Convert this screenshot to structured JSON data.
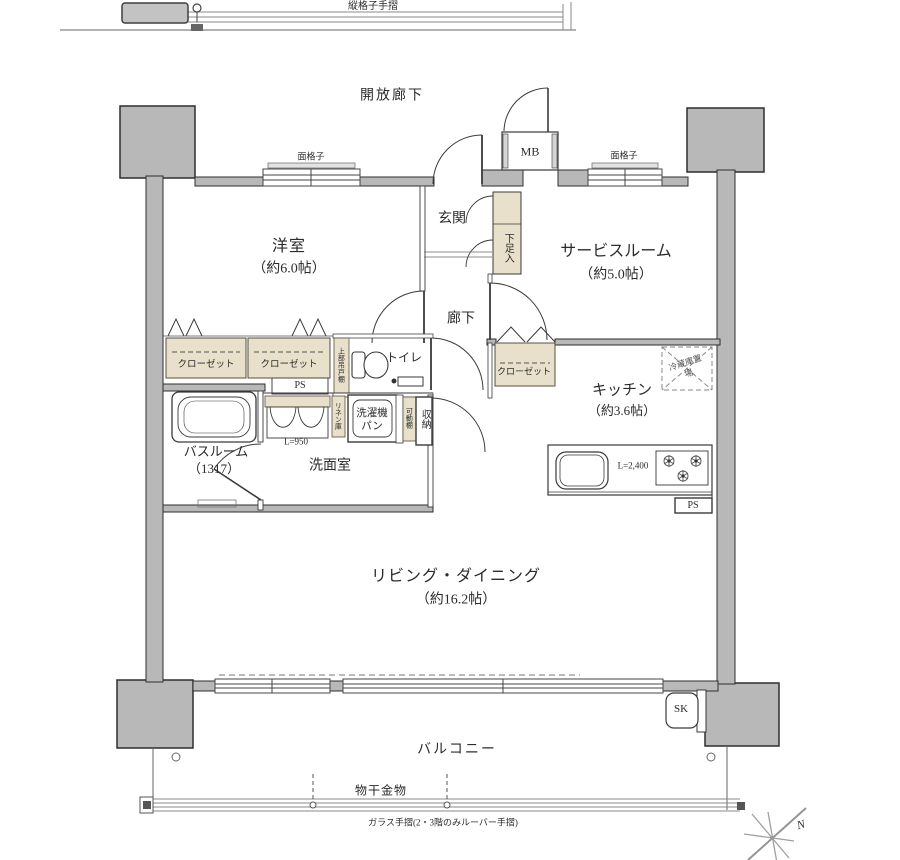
{
  "colors": {
    "wall_fill": "#b8b8b8",
    "wall_line": "#2e2e2e",
    "cabinet_fill": "#e8e0cb",
    "thin_line": "#8a8a8a"
  },
  "exterior": {
    "upper_corridor_rail": "縦格子手摺",
    "open_corridor": "開放廊下",
    "grille_left": "面格子",
    "grille_right": "面格子",
    "balcony": "バルコニー",
    "laundry_fitting": "物干金物",
    "glass_rail": "ガラス手摺(2・3階のみルーバー手摺)",
    "slop_sink": "SK",
    "compass_north": "N"
  },
  "rooms": {
    "entrance": {
      "name": "玄関"
    },
    "western_room": {
      "name": "洋室",
      "size": "（約6.0帖）"
    },
    "service_room": {
      "name": "サービスルーム",
      "size": "（約5.0帖）"
    },
    "hallway": {
      "name": "廊下"
    },
    "toilet": {
      "name": "トイレ"
    },
    "kitchen": {
      "name": "キッチン",
      "size": "（約3.6帖）"
    },
    "bathroom": {
      "name": "バスルーム",
      "size": "（1317）"
    },
    "washroom": {
      "name": "洗面室"
    },
    "living_dining": {
      "name": "リビング・ダイニング",
      "size": "（約16.2帖）"
    }
  },
  "fixtures": {
    "mb": "MB",
    "shoe_cabinet": "下足入",
    "closet_1": "クローゼット",
    "closet_2": "クローゼット",
    "closet_3": "クローゼット",
    "ps_1": "PS",
    "ps_2": "PS",
    "upper_cabinet": "上部吊戸棚",
    "fridge_space": "冷蔵庫置場",
    "linen_cabinet": "リネン庫",
    "washer_pan": "洗濯機パン",
    "movable_shelf": "可動棚",
    "storage": "収納",
    "vanity_width": "L=950",
    "counter_width": "L=2,400"
  }
}
